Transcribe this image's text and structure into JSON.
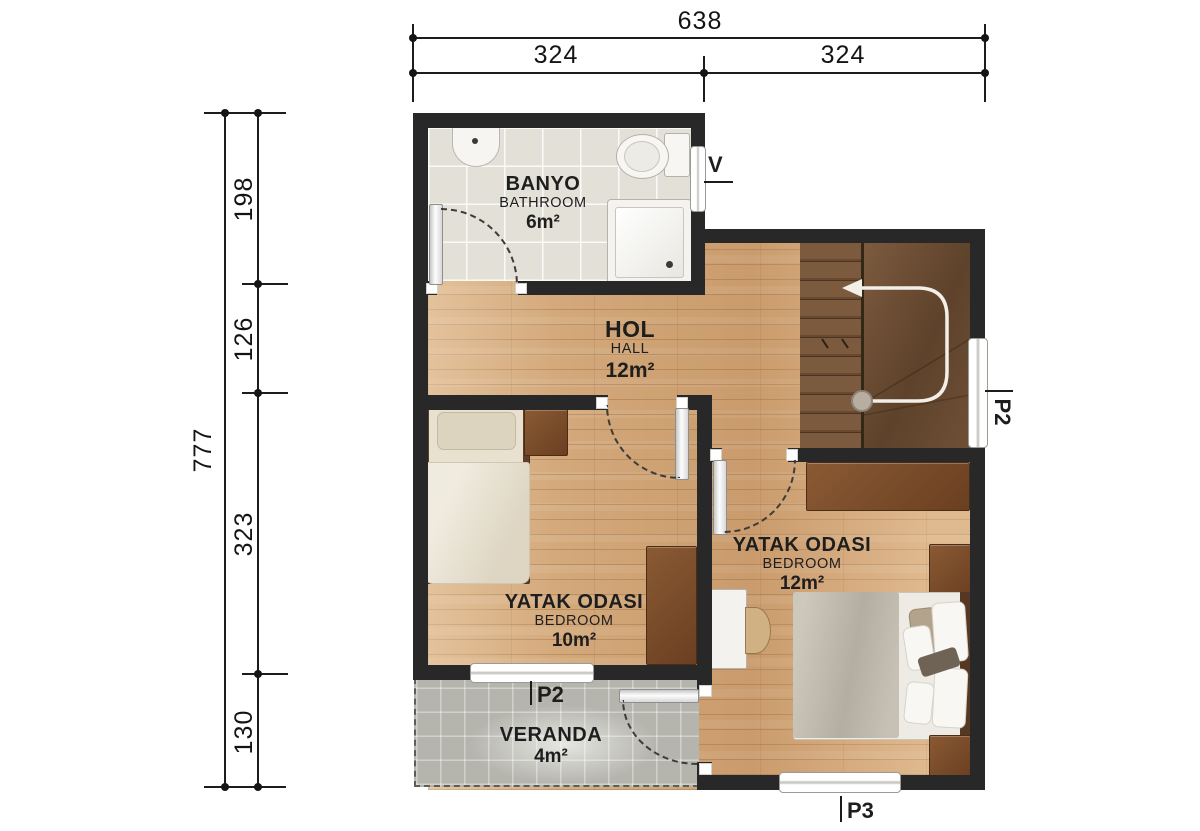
{
  "dimensions": {
    "top": {
      "total": "638",
      "seg1": "324",
      "seg2": "324"
    },
    "left": {
      "total": "777",
      "seg1": "198",
      "seg2": "126",
      "seg3": "323",
      "seg4": "130"
    }
  },
  "rooms": {
    "bathroom": {
      "name": "BANYO",
      "subname": "BATHROOM",
      "area": "6m²"
    },
    "hall": {
      "name": "HOL",
      "subname": "HALL",
      "area": "12m²"
    },
    "bedroom1": {
      "name": "YATAK ODASI",
      "subname": "BEDROOM",
      "area": "10m²"
    },
    "bedroom2": {
      "name": "YATAK ODASI",
      "subname": "BEDROOM",
      "area": "12m²"
    },
    "veranda": {
      "name": "VERANDA",
      "area": "4m²"
    }
  },
  "opening_tags": {
    "bathroom_window": "V",
    "side_window": "P2",
    "veranda_window": "P2",
    "rear_window": "P3"
  },
  "colors": {
    "wall": "#282828",
    "wood_floor": "#d3a87a",
    "bathroom_floor": "#e3e1d7",
    "veranda_floor": "#b5b5ad",
    "stairs_dark_wood": "#6b4c33",
    "furniture_brown": "#7a4b27",
    "dimension_ink": "#1c1c1c"
  }
}
